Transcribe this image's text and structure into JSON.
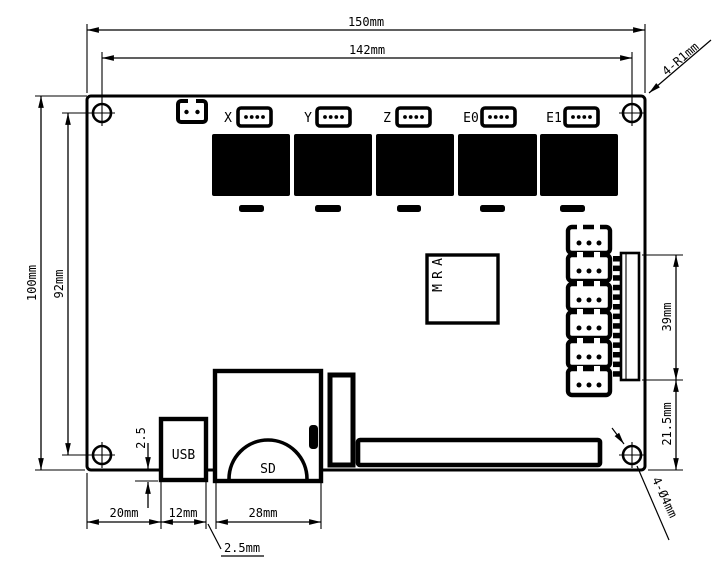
{
  "dims": {
    "overall_width": "150mm",
    "hole_span_width": "142mm",
    "overall_height": "100mm",
    "hole_span_height": "92mm",
    "left_edge_to_usb": "20mm",
    "usb_width": "12mm",
    "sd_width": "28mm",
    "usb_protrusion": "2.5",
    "usb_to_sd_gap": "2.5mm",
    "pin_header_length": "39mm",
    "pin_header_to_edge": "21.5mm",
    "corner_radius": "4-R1mm",
    "mounting_hole_dia": "4-Ø4mm"
  },
  "components": {
    "driver_labels": [
      "X",
      "Y",
      "Z",
      "E0",
      "E1"
    ],
    "cpu": "ARM",
    "usb": "USB",
    "sd": "SD"
  }
}
